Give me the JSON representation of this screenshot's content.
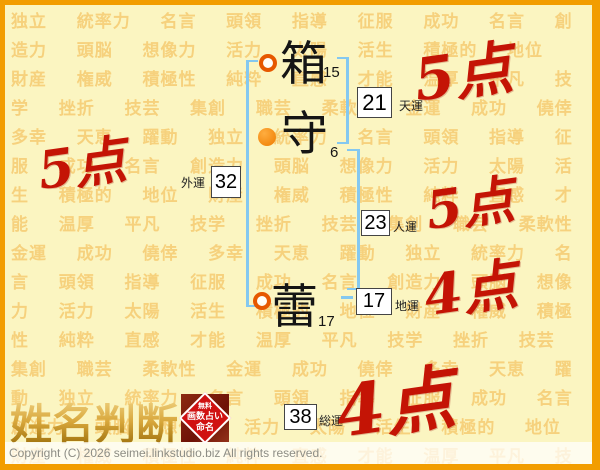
{
  "page": {
    "background_words": [
      "独立",
      "統率力",
      "名言",
      "頭領",
      "指導",
      "征服",
      "成功",
      "名言",
      "創造力",
      "頭脳",
      "想像力",
      "活力",
      "太陽",
      "活生",
      "積極的",
      "地位",
      "財産",
      "権威",
      "積極性",
      "純粋",
      "直感",
      "才能",
      "温厚",
      "平凡",
      "技学",
      "挫折",
      "技芸",
      "集創",
      "職芸",
      "柔軟性",
      "金運",
      "成功",
      "僥倖",
      "多幸",
      "天恵",
      "躍動"
    ]
  },
  "name": {
    "characters": [
      {
        "char": "箱",
        "strokes": "15",
        "marker": "ring"
      },
      {
        "char": "守",
        "strokes": "6",
        "marker": "dot"
      },
      {
        "char": "蕾",
        "strokes": "17",
        "marker": "ring"
      }
    ]
  },
  "fortunes": [
    {
      "id": "ten",
      "value": "21",
      "label": "天運",
      "score": "5点"
    },
    {
      "id": "gai",
      "value": "32",
      "label": "外運",
      "score": "5点"
    },
    {
      "id": "jin",
      "value": "23",
      "label": "人運",
      "score": "5点"
    },
    {
      "id": "chi",
      "value": "17",
      "label": "地運",
      "score": "4点"
    },
    {
      "id": "sou",
      "value": "38",
      "label": "総運",
      "score": "4点"
    }
  ],
  "logo": {
    "title": "姓名判断",
    "badge_lines": [
      "無料",
      "画数占い",
      "命名"
    ]
  },
  "footer": {
    "copyright": "Copyright (C) 2026 seimei.linkstudio.biz All rights reserved."
  },
  "colors": {
    "frame_orange": "#F29D00",
    "page_yellow": "#FBF5C1",
    "bracket_blue": "#84C8F0",
    "score_red": "#C41405",
    "marker_orange": "#E65800",
    "badge_red": "#D01111"
  }
}
